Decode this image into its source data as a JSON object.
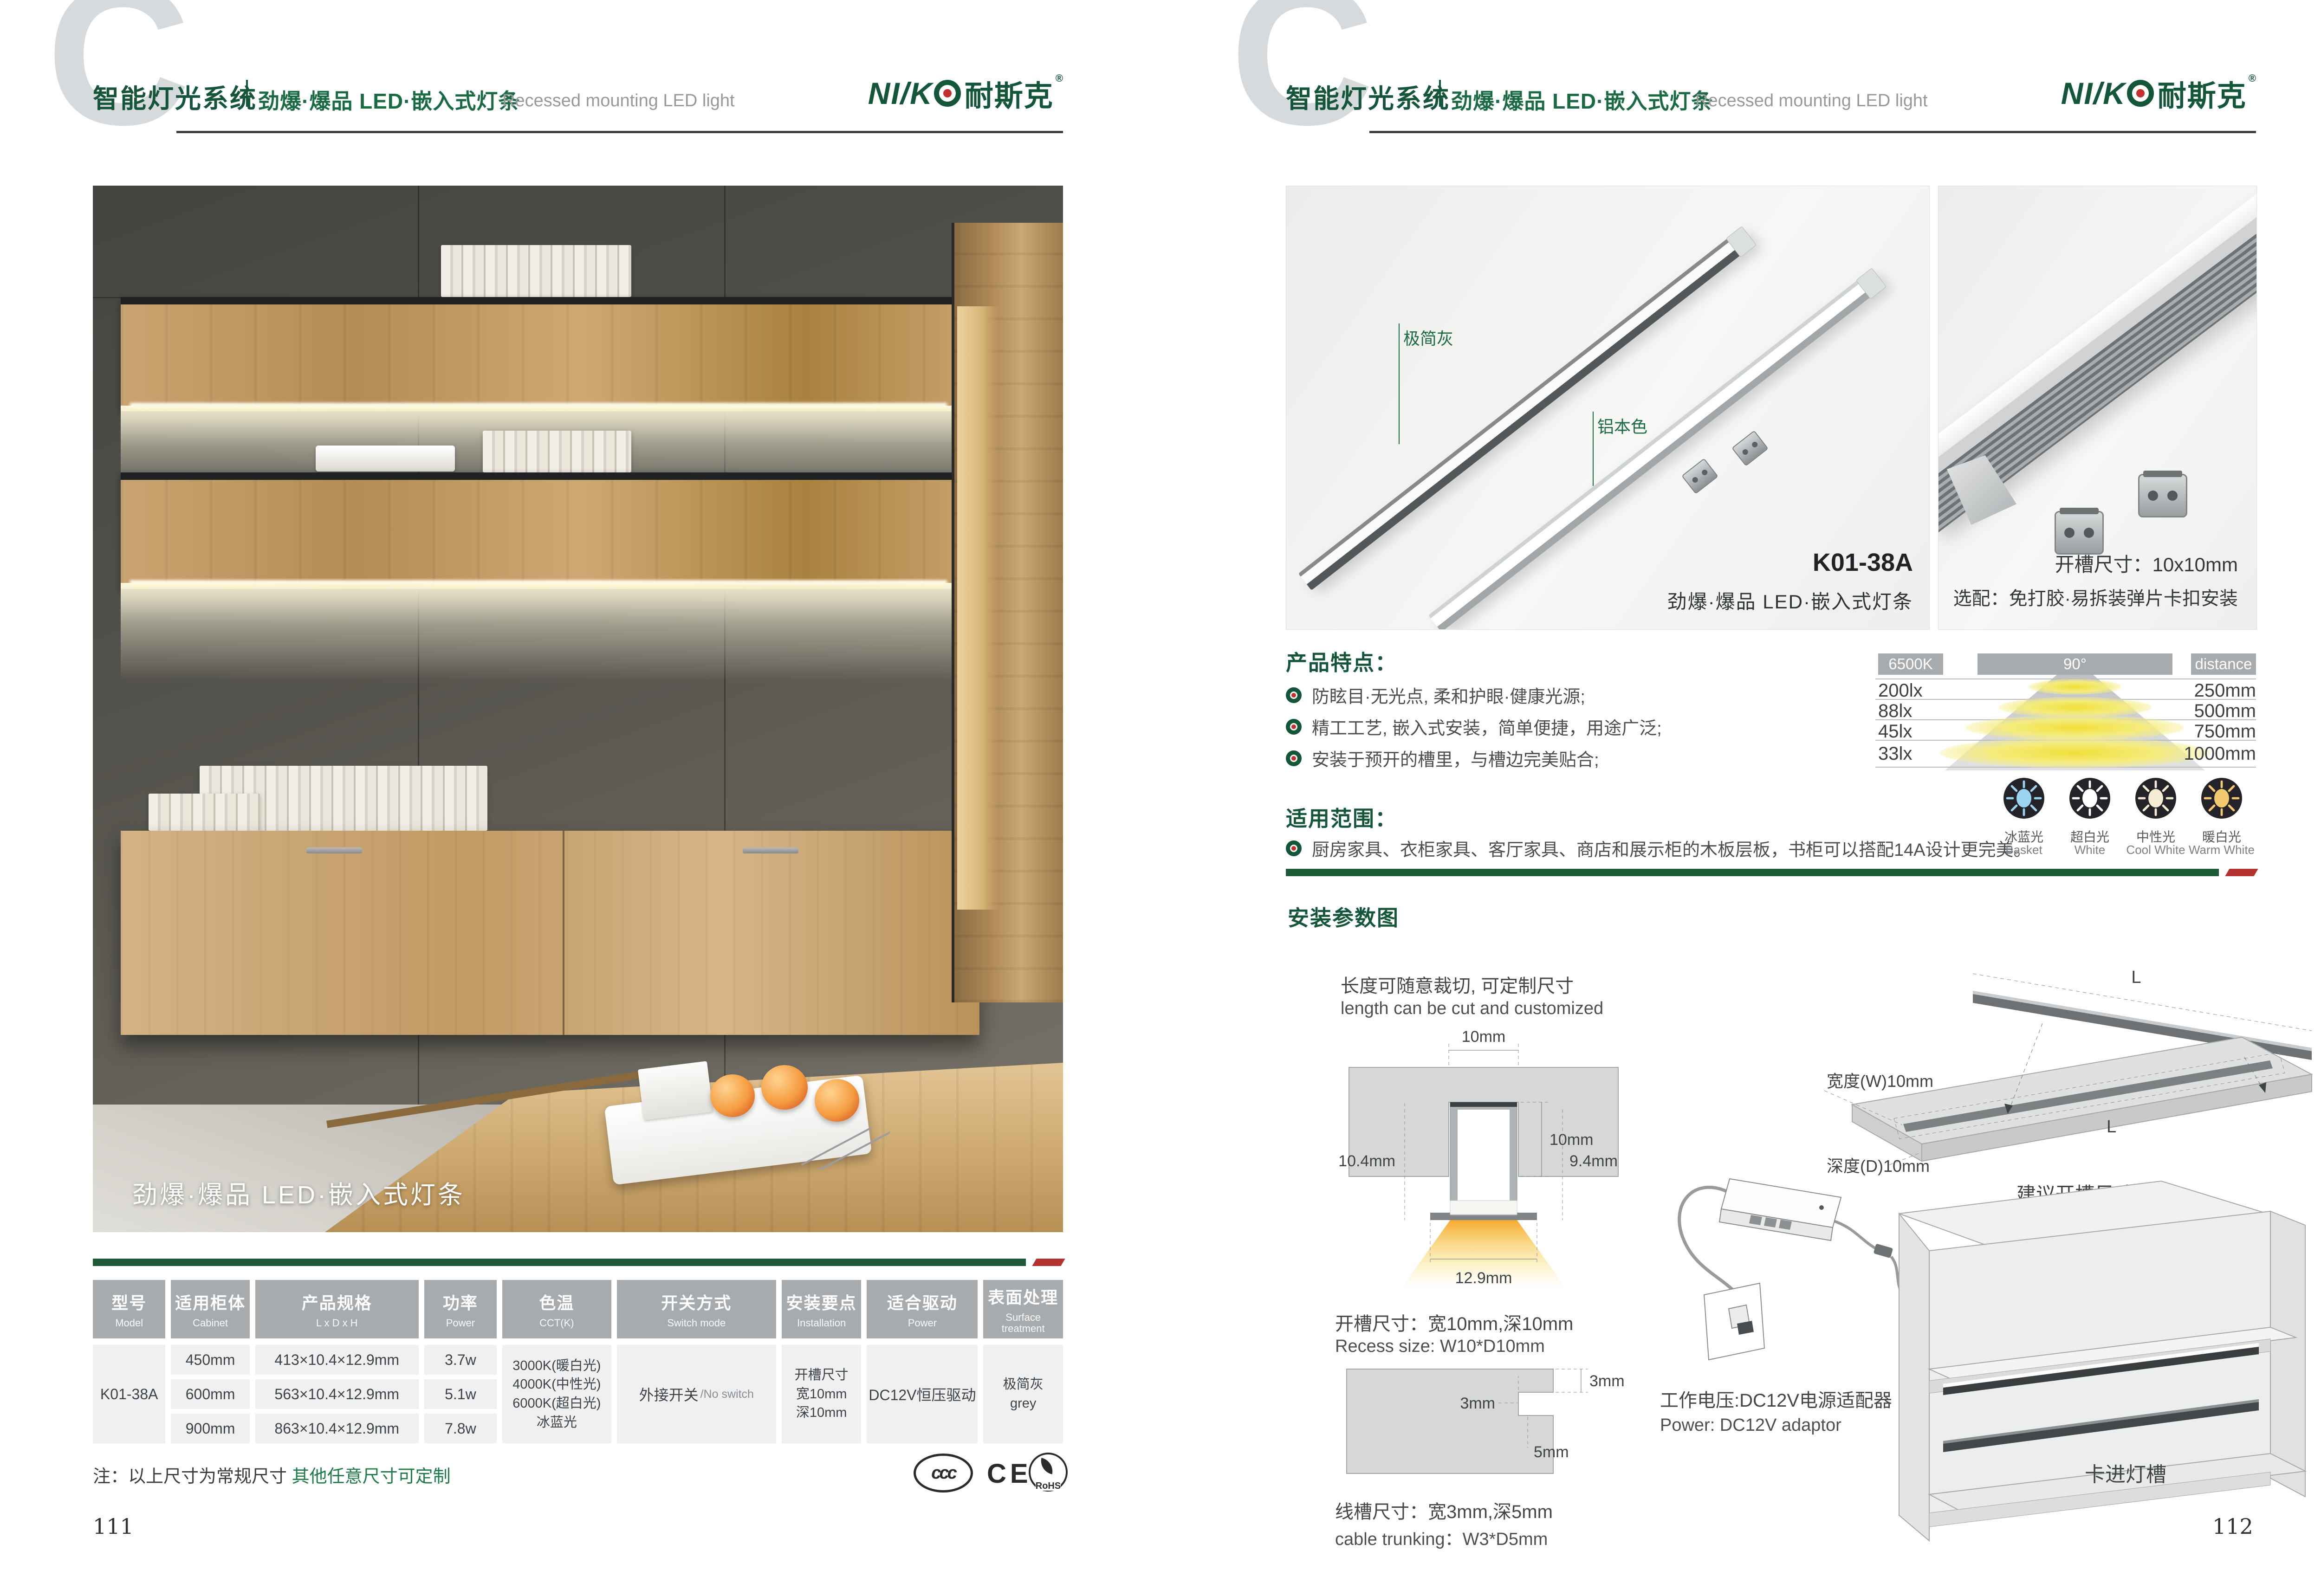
{
  "colors": {
    "brand_green": "#15563A",
    "series_green": "#1A6B44",
    "bar_green": "#1D5B38",
    "bar_red": "#B43230",
    "table_header_gray": "#A7ABAE",
    "cell_gray": "#EEF0F2",
    "text_dark": "#3C4043"
  },
  "header": {
    "watermark": "C",
    "system": "智能灯光系统",
    "series": "劲爆·爆品 LED·嵌入式灯条",
    "series_en": "Recessed mounting LED light",
    "logo_en": "NI/K",
    "logo_cn": "耐斯克",
    "logo_reg": "®"
  },
  "left_page": {
    "page_number": "111",
    "photo_caption": "劲爆·爆品 LED·嵌入式灯条",
    "note_prefix": "注：以上尺寸为常规尺寸 ",
    "note_highlight": "其他任意尺寸可定制",
    "certs": {
      "ccc": "ccc",
      "ce": "CE",
      "rohs": "RoHS"
    },
    "table": {
      "columns": [
        {
          "cn": "型号",
          "en": "Model"
        },
        {
          "cn": "适用柜体",
          "en": "Cabinet"
        },
        {
          "cn": "产品规格",
          "en": "L x D x H"
        },
        {
          "cn": "功率",
          "en": "Power"
        },
        {
          "cn": "色温",
          "en": "CCT(K)"
        },
        {
          "cn": "开关方式",
          "en": "Switch mode"
        },
        {
          "cn": "安装要点",
          "en": "Installation"
        },
        {
          "cn": "适合驱动",
          "en": "Power"
        },
        {
          "cn": "表面处理",
          "en": "Surface treatment"
        }
      ],
      "model": "K01-38A",
      "rows": [
        {
          "cabinet": "450mm",
          "spec": "413×10.4×12.9mm",
          "power": "3.7w"
        },
        {
          "cabinet": "600mm",
          "spec": "563×10.4×12.9mm",
          "power": "5.1w"
        },
        {
          "cabinet": "900mm",
          "spec": "863×10.4×12.9mm",
          "power": "7.8w"
        }
      ],
      "cct": [
        "3000K(暖白光)",
        "4000K(中性光)",
        "6000K(超白光)",
        "冰蓝光"
      ],
      "switch_cn": "外接开关",
      "switch_en": "/No switch",
      "install": [
        "开槽尺寸",
        "宽10mm",
        "深10mm"
      ],
      "driver": "DC12V恒压驱动",
      "surface": [
        "极简灰",
        "grey"
      ]
    }
  },
  "right_page": {
    "page_number": "112",
    "photo1": {
      "label_gray": "极简灰",
      "label_alu": "铝本色",
      "model": "K01-38A",
      "caption": "劲爆·爆品 LED·嵌入式灯条"
    },
    "photo2": {
      "line1": "开槽尺寸：10x10mm",
      "line2": "选配：免打胶·易拆装弹片卡扣安装"
    },
    "features": {
      "title": "产品特点：",
      "items": [
        "防眩目·无光点, 柔和护眼·健康光源;",
        "精工工艺, 嵌入式安装，简单便捷，用途广泛;",
        "安装于预开的槽里，与槽边完美贴合;"
      ]
    },
    "scope": {
      "title": "适用范围：",
      "item": "厨房家具、衣柜家具、客厅家具、商店和展示柜的木板层板，书柜可以搭配14A设计更完美。"
    },
    "photometry": {
      "cct_label": "6500K",
      "angle_label": "90°",
      "distance_label": "distance",
      "rows": [
        {
          "lux": "200lx",
          "distance": "250mm"
        },
        {
          "lux": "88lx",
          "distance": "500mm"
        },
        {
          "lux": "45lx",
          "distance": "750mm"
        },
        {
          "lux": "33lx",
          "distance": "1000mm"
        }
      ],
      "swatches": [
        {
          "cn": "冰蓝光",
          "en": "Basket",
          "color": "#9AD4F0"
        },
        {
          "cn": "超白光",
          "en": "White",
          "color": "#FFFFFF"
        },
        {
          "cn": "中性光",
          "en": "Cool White",
          "color": "#F4ECD2"
        },
        {
          "cn": "暖白光",
          "en": "Warm White",
          "color": "#F2C96E"
        }
      ]
    },
    "install": {
      "title": "安装参数图",
      "cut_cn": "长度可随意裁切, 可定制尺寸",
      "cut_en": "length can be cut and customized",
      "cross": {
        "top_w": "10mm",
        "depth": "10mm",
        "inner_w": "9.9mm",
        "left_h": "10.4mm",
        "right_h": "9.4mm",
        "bottom_w": "12.9mm"
      },
      "recess_cn": "开槽尺寸：宽10mm,深10mm",
      "recess_en": "Recess size: W10*D10mm",
      "trunk": {
        "h": "3mm",
        "w": "3mm",
        "d": "5mm"
      },
      "trunk_cn": "线槽尺寸：宽3mm,深5mm",
      "trunk_en": "cable trunking：W3*D5mm",
      "board": {
        "l_top": "L",
        "l_groove": "L",
        "width": "宽度(W)10mm",
        "depth": "深度(D)10mm",
        "caption": "建议开槽尺寸"
      },
      "power_cn": "工作电压:DC12V电源适配器",
      "power_en": "Power: DC12V adaptor",
      "clip_label": "卡进灯槽"
    }
  }
}
